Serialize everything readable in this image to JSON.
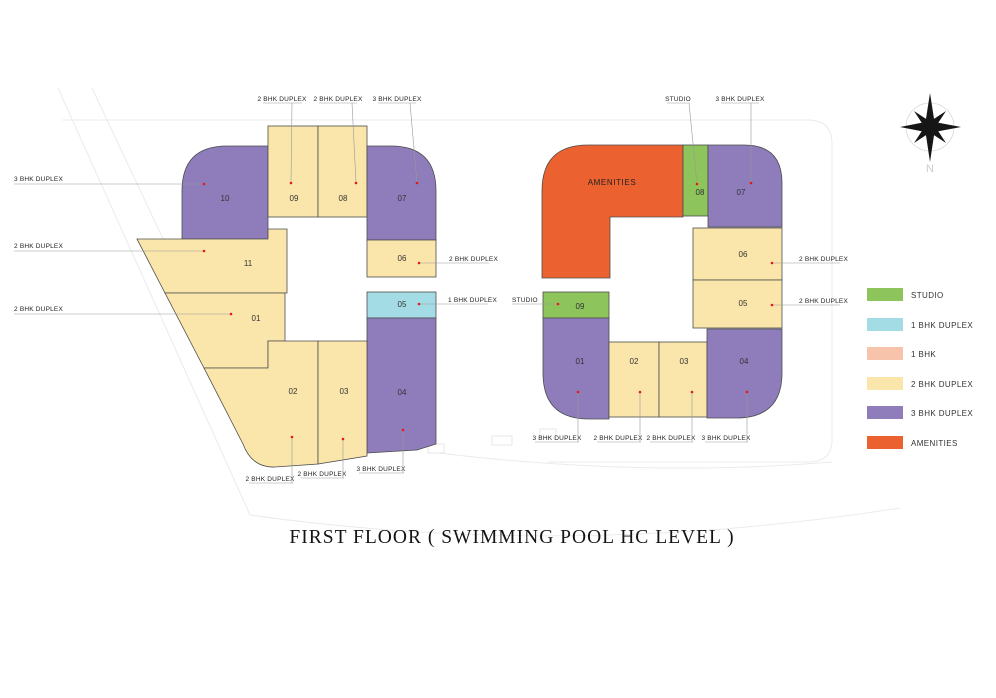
{
  "title": "FIRST FLOOR ( SWIMMING POOL HC LEVEL )",
  "compass": {
    "label": "N"
  },
  "colors": {
    "studio": "#8ec45c",
    "bhk1_duplex": "#a4dce6",
    "bhk1": "#f8c3ab",
    "bhk2_duplex": "#fae6ab",
    "bhk3_duplex": "#8e7cbb",
    "amenities": "#eb612f"
  },
  "legend": {
    "items": [
      {
        "label": "STUDIO",
        "color": "#8ec45c"
      },
      {
        "label": "1 BHK DUPLEX",
        "color": "#a4dce6"
      },
      {
        "label": "1 BHK",
        "color": "#f8c3ab"
      },
      {
        "label": "2 BHK DUPLEX",
        "color": "#fae6ab"
      },
      {
        "label": "3 BHK DUPLEX",
        "color": "#8e7cbb"
      },
      {
        "label": "AMENITIES",
        "color": "#eb612f"
      }
    ]
  },
  "left_block": {
    "units": {
      "u01": {
        "number": "01",
        "type": "2 BHK DUPLEX"
      },
      "u02": {
        "number": "02",
        "type": "2 BHK DUPLEX"
      },
      "u03": {
        "number": "03",
        "type": "2 BHK DUPLEX"
      },
      "u04": {
        "number": "04",
        "type": "3 BHK DUPLEX"
      },
      "u05": {
        "number": "05",
        "type": "1 BHK DUPLEX"
      },
      "u06": {
        "number": "06",
        "type": "2 BHK DUPLEX"
      },
      "u07": {
        "number": "07",
        "type": "3 BHK DUPLEX"
      },
      "u08": {
        "number": "08",
        "type": "2 BHK DUPLEX"
      },
      "u09": {
        "number": "09",
        "type": "2 BHK DUPLEX"
      },
      "u10": {
        "number": "10",
        "type": "3 BHK DUPLEX"
      },
      "u11": {
        "number": "11",
        "type": "2 BHK DUPLEX"
      }
    }
  },
  "right_block": {
    "amenities_label": "AMENITIES",
    "units": {
      "u01": {
        "number": "01",
        "type": "3 BHK DUPLEX"
      },
      "u02": {
        "number": "02",
        "type": "2 BHK DUPLEX"
      },
      "u03": {
        "number": "03",
        "type": "2 BHK DUPLEX"
      },
      "u04": {
        "number": "04",
        "type": "3 BHK DUPLEX"
      },
      "u05": {
        "number": "05",
        "type": "2 BHK DUPLEX"
      },
      "u06": {
        "number": "06",
        "type": "2 BHK DUPLEX"
      },
      "u07": {
        "number": "07",
        "type": "3 BHK DUPLEX"
      },
      "u08": {
        "number": "08",
        "type": "STUDIO"
      },
      "u09": {
        "number": "09",
        "type": "STUDIO"
      }
    }
  },
  "annotations": {
    "top_left": [
      "2 BHK DUPLEX",
      "2 BHK DUPLEX",
      "3 BHK DUPLEX"
    ],
    "top_right": [
      "STUDIO",
      "3 BHK DUPLEX"
    ],
    "left": [
      "3 BHK DUPLEX",
      "2 BHK DUPLEX",
      "2 BHK DUPLEX"
    ],
    "middle": [
      "2 BHK DUPLEX",
      "1 BHK DUPLEX",
      "STUDIO"
    ],
    "right": [
      "2 BHK DUPLEX",
      "2 BHK DUPLEX"
    ],
    "bottom_left": [
      "2 BHK DUPLEX",
      "2 BHK DUPLEX",
      "3 BHK DUPLEX"
    ],
    "bottom_right": [
      "3 BHK DUPLEX",
      "2 BHK DUPLEX",
      "2 BHK DUPLEX",
      "3 BHK DUPLEX"
    ]
  }
}
